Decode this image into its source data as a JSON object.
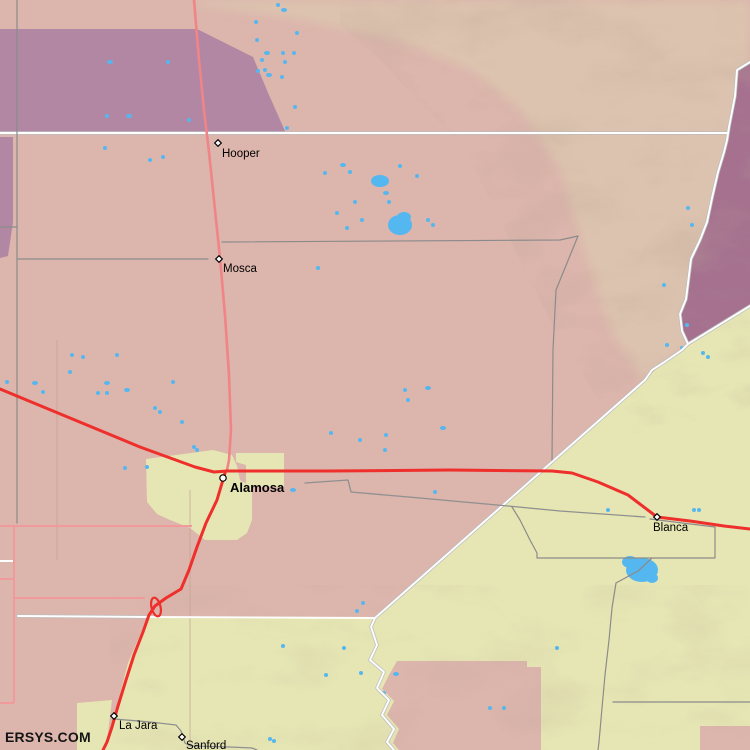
{
  "watermark": {
    "label": "ERSYS.COM"
  },
  "towns": [
    {
      "id": "hooper",
      "name": "Hooper",
      "marker": "diamond",
      "x": 218,
      "y": 143,
      "lx": 222,
      "ly": 157,
      "bold": false
    },
    {
      "id": "mosca",
      "name": "Mosca",
      "marker": "diamond",
      "x": 219,
      "y": 259,
      "lx": 223,
      "ly": 272,
      "bold": false
    },
    {
      "id": "alamosa",
      "name": "Alamosa",
      "marker": "circle",
      "x": 223,
      "y": 478,
      "lx": 230,
      "ly": 492,
      "bold": true
    },
    {
      "id": "blanca",
      "name": "Blanca",
      "marker": "diamond",
      "x": 657,
      "y": 517,
      "lx": 653,
      "ly": 531,
      "bold": false
    },
    {
      "id": "la-jara",
      "name": "La Jara",
      "marker": "diamond",
      "x": 114,
      "y": 716,
      "lx": 119,
      "ly": 729,
      "bold": false
    },
    {
      "id": "sanford",
      "name": "Sanford",
      "marker": "diamond",
      "x": 182,
      "y": 737,
      "lx": 186,
      "ly": 749,
      "bold": false
    }
  ],
  "lakes": [
    [
      380,
      181,
      9,
      6
    ],
    [
      400,
      225,
      12,
      10
    ],
    [
      404,
      217,
      7,
      5
    ],
    [
      110,
      62,
      3,
      2
    ],
    [
      168,
      62,
      2,
      2
    ],
    [
      107,
      116,
      2,
      2
    ],
    [
      129,
      116,
      3,
      2
    ],
    [
      189,
      120,
      2,
      2
    ],
    [
      256,
      22,
      2,
      2
    ],
    [
      278,
      5,
      2,
      2
    ],
    [
      284,
      10,
      3,
      2
    ],
    [
      257,
      40,
      2,
      2
    ],
    [
      267,
      53,
      3,
      2
    ],
    [
      283,
      53,
      2,
      2
    ],
    [
      294,
      53,
      2,
      2
    ],
    [
      258,
      71,
      2,
      2
    ],
    [
      265,
      70,
      2,
      2
    ],
    [
      269,
      75,
      3,
      2
    ],
    [
      282,
      77,
      2,
      2
    ],
    [
      285,
      62,
      2,
      2
    ],
    [
      295,
      107,
      2,
      2
    ],
    [
      287,
      128,
      2,
      2
    ],
    [
      297,
      33,
      2,
      2
    ],
    [
      262,
      60,
      2,
      2
    ],
    [
      343,
      165,
      3,
      2
    ],
    [
      350,
      172,
      2,
      2
    ],
    [
      400,
      166,
      2,
      2
    ],
    [
      417,
      176,
      2,
      2
    ],
    [
      325,
      173,
      2,
      2
    ],
    [
      386,
      193,
      3,
      2
    ],
    [
      389,
      202,
      2,
      2
    ],
    [
      355,
      202,
      2,
      2
    ],
    [
      337,
      213,
      2,
      2
    ],
    [
      362,
      220,
      2,
      2
    ],
    [
      347,
      228,
      2,
      2
    ],
    [
      428,
      220,
      2,
      2
    ],
    [
      433,
      225,
      2,
      2
    ],
    [
      318,
      268,
      2,
      2
    ],
    [
      150,
      160,
      2,
      2
    ],
    [
      163,
      157,
      2,
      2
    ],
    [
      105,
      148,
      2,
      2
    ],
    [
      688,
      208,
      2,
      2
    ],
    [
      692,
      225,
      2,
      2
    ],
    [
      664,
      285,
      2,
      2
    ],
    [
      687,
      325,
      2,
      2
    ],
    [
      667,
      345,
      2,
      2
    ],
    [
      682,
      348,
      2,
      2
    ],
    [
      703,
      353,
      2,
      2
    ],
    [
      708,
      357,
      2,
      2
    ],
    [
      7,
      382,
      2,
      2
    ],
    [
      35,
      383,
      3,
      2
    ],
    [
      43,
      392,
      2,
      2
    ],
    [
      70,
      372,
      2,
      2
    ],
    [
      72,
      355,
      2,
      2
    ],
    [
      83,
      357,
      2,
      2
    ],
    [
      107,
      383,
      3,
      2
    ],
    [
      98,
      393,
      2,
      2
    ],
    [
      107,
      393,
      2,
      2
    ],
    [
      117,
      355,
      2,
      2
    ],
    [
      127,
      390,
      3,
      2
    ],
    [
      155,
      408,
      2,
      2
    ],
    [
      160,
      412,
      2,
      2
    ],
    [
      173,
      382,
      2,
      2
    ],
    [
      182,
      422,
      2,
      2
    ],
    [
      197,
      450,
      2,
      2
    ],
    [
      125,
      468,
      2,
      2
    ],
    [
      147,
      467,
      2,
      2
    ],
    [
      194,
      447,
      2,
      2
    ],
    [
      386,
      435,
      2,
      2
    ],
    [
      405,
      390,
      2,
      2
    ],
    [
      428,
      388,
      3,
      2
    ],
    [
      408,
      400,
      2,
      2
    ],
    [
      443,
      428,
      3,
      2
    ],
    [
      385,
      450,
      2,
      2
    ],
    [
      435,
      492,
      2,
      2
    ],
    [
      331,
      433,
      2,
      2
    ],
    [
      293,
      490,
      3,
      2
    ],
    [
      360,
      440,
      2,
      2
    ],
    [
      642,
      570,
      16,
      12
    ],
    [
      630,
      562,
      8,
      6
    ],
    [
      652,
      578,
      6,
      5
    ],
    [
      694,
      510,
      2,
      2
    ],
    [
      699,
      510,
      2,
      2
    ],
    [
      608,
      510,
      2,
      2
    ],
    [
      283,
      646,
      2,
      2
    ],
    [
      344,
      648,
      2,
      2
    ],
    [
      326,
      675,
      2,
      2
    ],
    [
      361,
      673,
      2,
      2
    ],
    [
      396,
      674,
      3,
      2
    ],
    [
      383,
      693,
      3,
      2
    ],
    [
      270,
      739,
      2,
      2
    ],
    [
      274,
      741,
      2,
      2
    ],
    [
      490,
      708,
      2,
      2
    ],
    [
      504,
      708,
      2,
      2
    ],
    [
      557,
      648,
      2,
      2
    ],
    [
      363,
      603,
      2,
      2
    ],
    [
      357,
      611,
      2,
      2
    ]
  ],
  "colors": {
    "plain_pink": "#dcb5ac",
    "plateau_tan": "#dcc3af",
    "refuge_purple": "#b287a4",
    "mountain_purple": "#a5718f",
    "valley_yellow": "#e6e6b4",
    "lake_blue": "#55b7ef",
    "highway_red": "#ee2f2b",
    "state_road_pink": "#f08486",
    "local_road_pink": "#f09a9b",
    "boundary_gray": "#8b8b8b",
    "county_line_white": "#ffffff",
    "label_black": "#000000"
  }
}
